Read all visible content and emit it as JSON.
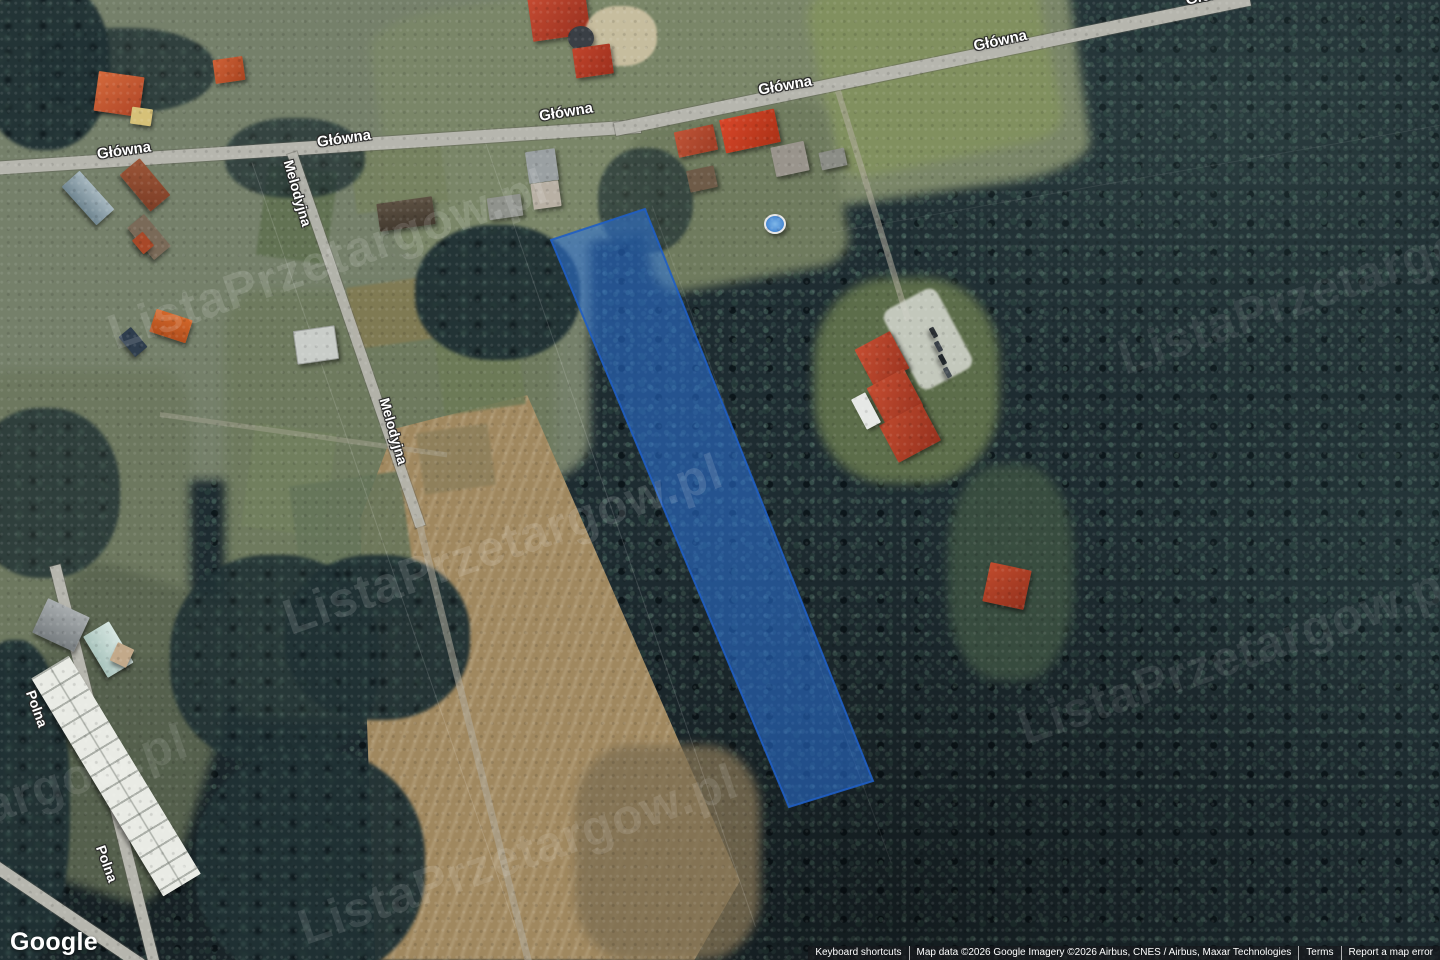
{
  "watermark": {
    "text": "ListaPrzetargow.pl"
  },
  "branding": {
    "logo_text": "Google"
  },
  "map": {
    "road_labels": [
      "Główna",
      "Główna",
      "Główna",
      "Główna",
      "Główna",
      "Główna",
      "Melodyjna",
      "Melodyjna",
      "Polna",
      "Polna"
    ]
  },
  "parcel": {
    "fill": "#2b74dc",
    "fill_opacity": "0.55",
    "stroke": "#1f5ec4",
    "stroke_opacity": "0.9"
  },
  "attribution": {
    "keyboard_shortcuts": "Keyboard shortcuts",
    "map_data": "Map data ©2026 Google",
    "imagery": "Imagery ©2026 Airbus, CNES / Airbus, Maxar Technologies",
    "terms": "Terms",
    "report_error": "Report a map error"
  }
}
